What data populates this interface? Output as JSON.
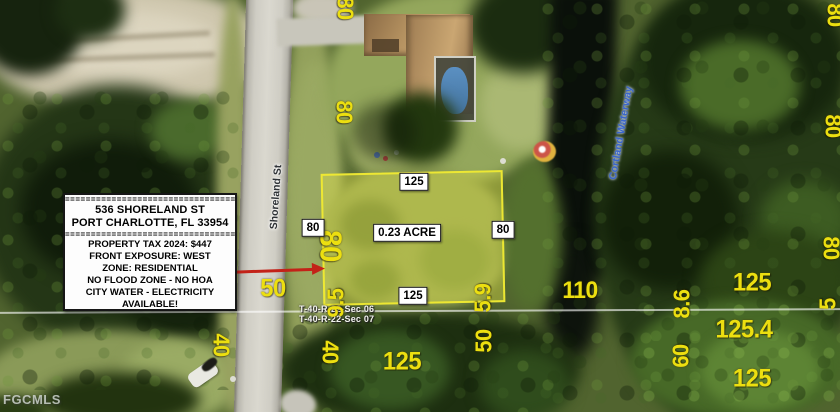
{
  "watermark": "FGCMLS",
  "street_label": "Shoreland St",
  "waterway_label": "Cortland Waterway",
  "section_lines": {
    "top": "T-40-R-22-Sec 06",
    "bottom": "T-40-R-22-Sec 07"
  },
  "info_box": {
    "divider": "==========================================",
    "address_line1": "536 SHORELAND ST",
    "address_line2": "PORT CHARLOTTE, FL 33954",
    "details": [
      "PROPERTY TAX 2024: $447",
      "FRONT EXPOSURE: WEST",
      "ZONE: RESIDENTIAL",
      "NO FLOOD ZONE - NO HOA",
      "CITY WATER - ELECTRICITY",
      "AVAILABLE!"
    ]
  },
  "parcel_labels": [
    {
      "text": "125",
      "x": 414,
      "y": 182
    },
    {
      "text": "80",
      "x": 313,
      "y": 228
    },
    {
      "text": "0.23 ACRE",
      "x": 407,
      "y": 233
    },
    {
      "text": "80",
      "x": 503,
      "y": 230
    },
    {
      "text": "125",
      "x": 413,
      "y": 296
    }
  ],
  "measurements": [
    {
      "t": "80",
      "x": 345,
      "y": 8,
      "r": 90,
      "s": 23
    },
    {
      "t": "80",
      "x": 344,
      "y": 112,
      "r": 90,
      "s": 23
    },
    {
      "t": "80",
      "x": 331,
      "y": 246,
      "r": 90,
      "s": 31
    },
    {
      "t": "9.5",
      "x": 336,
      "y": 303,
      "r": -90,
      "s": 23
    },
    {
      "t": "40",
      "x": 330,
      "y": 352,
      "r": 90,
      "s": 23
    },
    {
      "t": "50",
      "x": 273,
      "y": 289,
      "r": 0,
      "s": 25
    },
    {
      "t": "5.9",
      "x": 483,
      "y": 298,
      "r": -90,
      "s": 23
    },
    {
      "t": "50",
      "x": 484,
      "y": 341,
      "r": -90,
      "s": 23
    },
    {
      "t": "40",
      "x": 221,
      "y": 345,
      "r": 90,
      "s": 23
    },
    {
      "t": "110",
      "x": 580,
      "y": 291,
      "r": 0,
      "s": 24
    },
    {
      "t": "8.6",
      "x": 682,
      "y": 304,
      "r": -90,
      "s": 23
    },
    {
      "t": "60",
      "x": 681,
      "y": 356,
      "r": -90,
      "s": 23
    },
    {
      "t": "125",
      "x": 402,
      "y": 362,
      "r": 0,
      "s": 25
    },
    {
      "t": "125",
      "x": 752,
      "y": 283,
      "r": 0,
      "s": 25
    },
    {
      "t": "125.4",
      "x": 744,
      "y": 330,
      "r": 0,
      "s": 25
    },
    {
      "t": "125",
      "x": 752,
      "y": 379,
      "r": 0,
      "s": 25
    },
    {
      "t": "80",
      "x": 833,
      "y": 126,
      "r": 90,
      "s": 23
    },
    {
      "t": "80",
      "x": 831,
      "y": 248,
      "r": 90,
      "s": 23
    },
    {
      "t": "5",
      "x": 828,
      "y": 304,
      "r": -90,
      "s": 23
    },
    {
      "t": "80",
      "x": 835,
      "y": 15,
      "r": 90,
      "s": 23
    }
  ],
  "colors": {
    "annotation_yellow": "#ecdf10",
    "label_background": "#ffffff",
    "label_text": "#000000",
    "arrow_red": "#c32218",
    "waterway_label_blue": "#3a66cc",
    "lot_highlight": "#e8e442",
    "street_label_gray": "#2e3236"
  }
}
